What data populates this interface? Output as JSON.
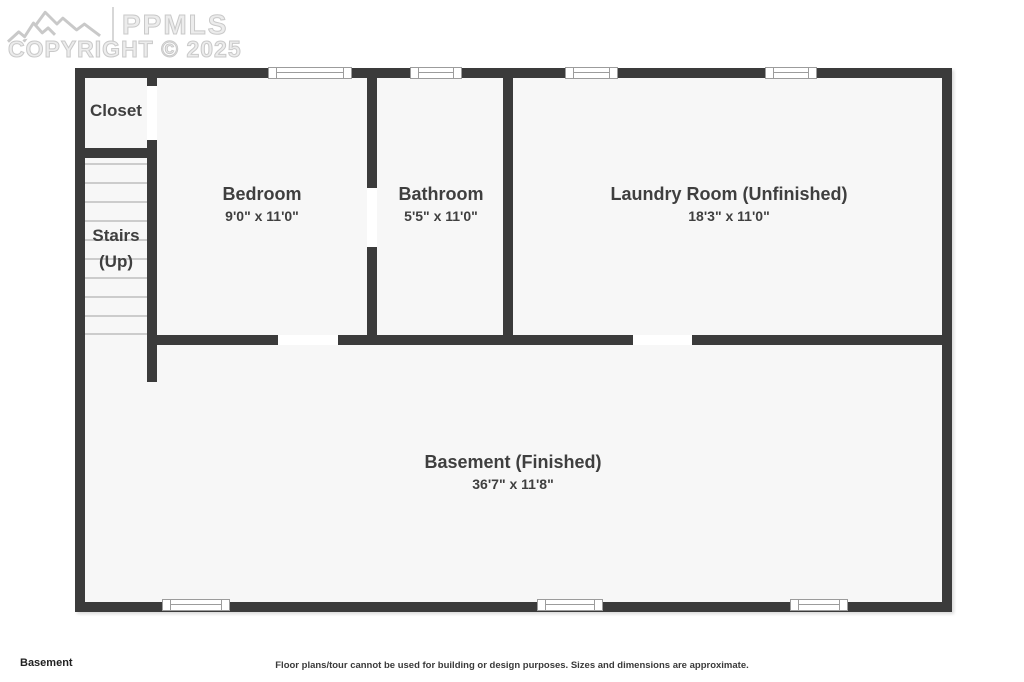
{
  "watermark": {
    "logo_text": "PPMLS",
    "copyright": "COPYRIGHT © 2025"
  },
  "colors": {
    "wall": "#3b3b3b",
    "floor": "#f7f7f7",
    "text": "#3f3f3f",
    "stairline": "#cccccc",
    "windowline": "#9c9c9c",
    "wm": "#c9c9c9"
  },
  "rooms": {
    "closet": {
      "name": "Closet"
    },
    "stairs": {
      "name": "Stairs",
      "name2": "(Up)"
    },
    "bedroom": {
      "name": "Bedroom",
      "dims": "9'0\" x 11'0\""
    },
    "bathroom": {
      "name": "Bathroom",
      "dims": "5'5\" x 11'0\""
    },
    "laundry": {
      "name": "Laundry Room (Unfinished)",
      "dims": "18'3\" x 11'0\""
    },
    "basement": {
      "name": "Basement (Finished)",
      "dims": "36'7\" x 11'8\""
    }
  },
  "footer": {
    "floor_label": "Basement",
    "disclaimer": "Floor plans/tour cannot be used for building or design purposes. Sizes and dimensions are approximate."
  }
}
